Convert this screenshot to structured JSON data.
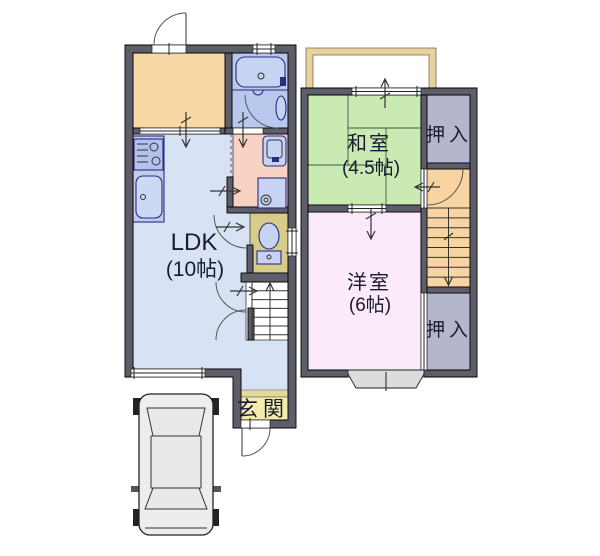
{
  "page": {
    "description": "Japanese two-storey apartment floor plan with parking space",
    "background": "#ffffff"
  },
  "floor1": {
    "ldk_label": "LDK",
    "ldk_size": "(10帖)",
    "genkan_label": "玄関"
  },
  "floor2": {
    "washitsu_label": "和室",
    "washitsu_size": "(4.5帖)",
    "oshiire_top_label": "押入",
    "yoshitsu_label": "洋室",
    "yoshitsu_size": "(6帖)",
    "oshiire_bottom_label": "押入"
  },
  "colors": {
    "wall": "#5e5e6a",
    "room_orange": "#f8d8a4",
    "room_ldk": "#d7e3f4",
    "room_bath": "#b9c9ee",
    "fixture_blue": "#c6d3f3",
    "kitchen_counter": "#bfccee",
    "stove": "#b2c2ea",
    "sink": "#cdd9f4",
    "room_washroom": "#f8d2c2",
    "room_toilet": "#d8cc8a",
    "genkan_floor": "#f2edaa",
    "genkan_step": "#e4d89c",
    "stairs_1f": "#ffffff",
    "room_washitsu": "#c9eab2",
    "room_oshiire": "#b3b6cd",
    "room_stairs2f": "#f8d4a2",
    "room_yoshitsu": "#fbeafa",
    "balcony": "#e8d2a0",
    "bay_window": "#dcdcdc",
    "car_body": "#ededed",
    "text": "#1b1b30"
  }
}
